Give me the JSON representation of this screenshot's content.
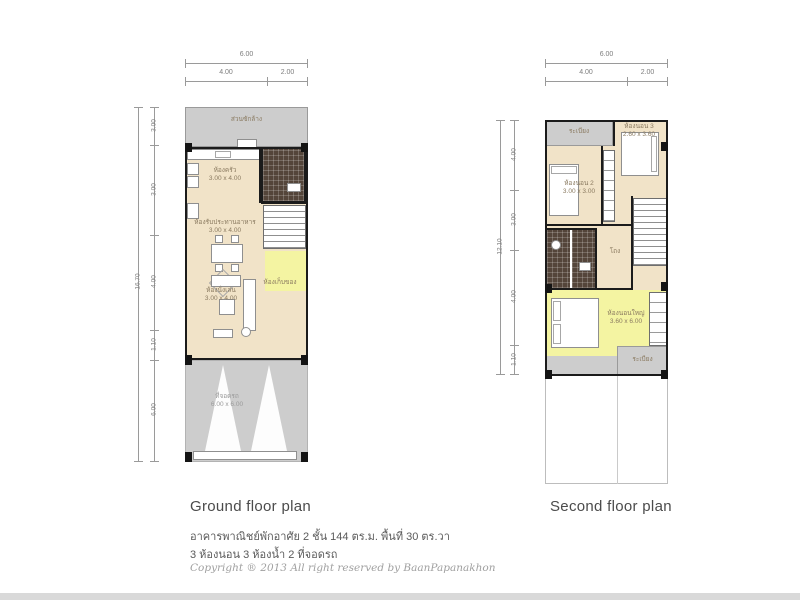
{
  "colors": {
    "floor_cream": "#f1e3c8",
    "highlight_yellow": "#f4f4a2",
    "outdoor_gray": "#cdcdcd",
    "bath_tile": "#54453a",
    "wall_black": "#1b1b1b"
  },
  "ground": {
    "caption": "Ground floor plan",
    "dims_top": {
      "total": "6.00",
      "seg1": "4.00",
      "seg2": "2.00"
    },
    "dims_left": {
      "total": "16.70",
      "seg1": "3.00",
      "seg2": "3.00",
      "seg3": "4.00",
      "seg4": "1.10",
      "seg5": "6.00"
    },
    "laundry": {
      "label": "ส่วนซักล้าง"
    },
    "kitchen": {
      "label": "ห้องครัว",
      "size": "3.00 x 4.00"
    },
    "dining": {
      "label": "ห้องรับประทานอาหาร",
      "size": "3.00 x 4.00"
    },
    "living": {
      "label": "ห้องนั่งเล่น",
      "size": "3.00 x 4.00"
    },
    "storage": {
      "label": "ห้องเก็บของ"
    },
    "garage": {
      "label": "ที่จอดรถ",
      "size": "6.00 x 6.00"
    }
  },
  "second": {
    "caption": "Second floor plan",
    "dims_top": {
      "total": "6.00",
      "seg1": "4.00",
      "seg2": "2.00"
    },
    "dims_left": {
      "total": "12.10",
      "seg1": "4.00",
      "seg2": "3.00",
      "seg3": "4.00",
      "seg4": "1.10"
    },
    "balcony_top": {
      "label": "ระเบียง"
    },
    "bedroom3": {
      "label": "ห้องนอน 3",
      "size": "2.60 x 3.60"
    },
    "bedroom2": {
      "label": "ห้องนอน 2",
      "size": "3.00 x 3.00"
    },
    "hall": {
      "label": "โถง"
    },
    "master": {
      "label": "ห้องนอนใหญ่",
      "size": "3.60 x 6.00"
    },
    "balcony_bottom": {
      "label": "ระเบียง"
    }
  },
  "footer": {
    "line1": "อาคารพาณิชย์พักอาศัย 2 ชั้น 144 ตร.ม. พื้นที่ 30 ตร.วา",
    "line2": "3 ห้องนอน 3 ห้องน้ำ 2 ที่จอดรถ",
    "copyright": "Copyright ® 2013 All right reserved by BaanPapanakhon"
  }
}
